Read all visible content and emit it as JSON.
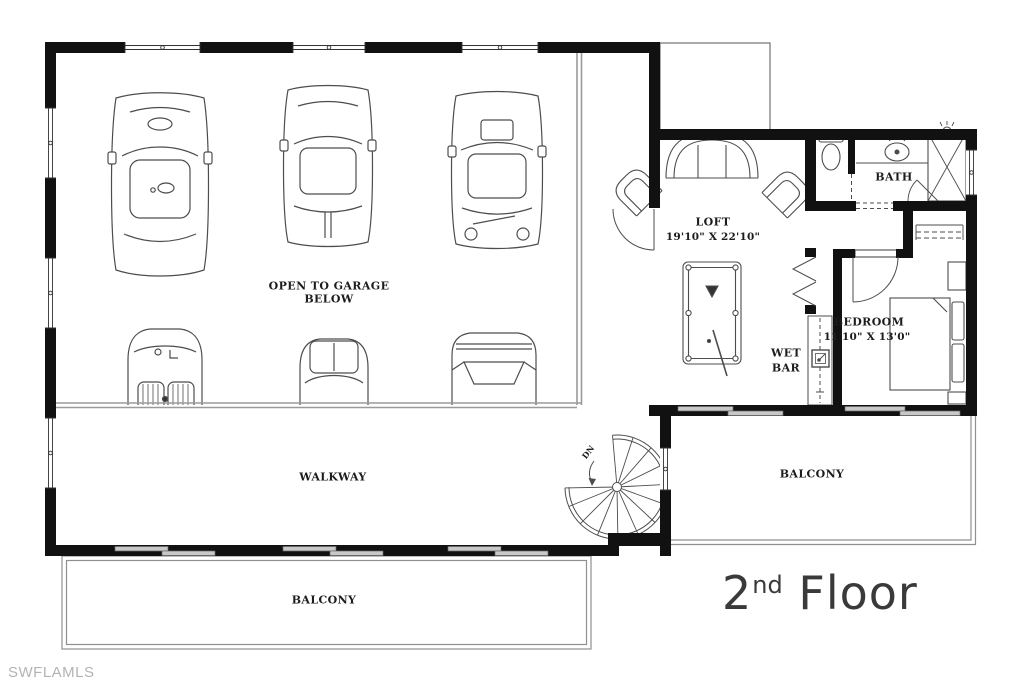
{
  "watermark": "SWFLAMLS",
  "floor_title": {
    "number": "2",
    "ordinal": "nd",
    "word": "Floor"
  },
  "labels": {
    "open_to_garage_line1": "OPEN TO GARAGE",
    "open_to_garage_line2": "BELOW",
    "loft": "LOFT",
    "loft_dims": "19'10\" X 22'10\"",
    "bath": "BATH",
    "bedroom": "BEDROOM",
    "bedroom_dims": "11'10\" X 13'0\"",
    "wet_bar_line1": "WET",
    "wet_bar_line2": "BAR",
    "walkway": "WALKWAY",
    "balcony_south": "BALCONY",
    "balcony_east": "BALCONY",
    "stair_down": "DN"
  },
  "colors": {
    "background": "#ffffff",
    "wall": "#111111",
    "thin_line": "#4d4d4d",
    "railing": "#9b9b9b",
    "window_glass": "#c8c8c8",
    "label_text": "#1c1c1c",
    "title_text": "#3a3a3a",
    "watermark_text": "#b3b3b3"
  }
}
